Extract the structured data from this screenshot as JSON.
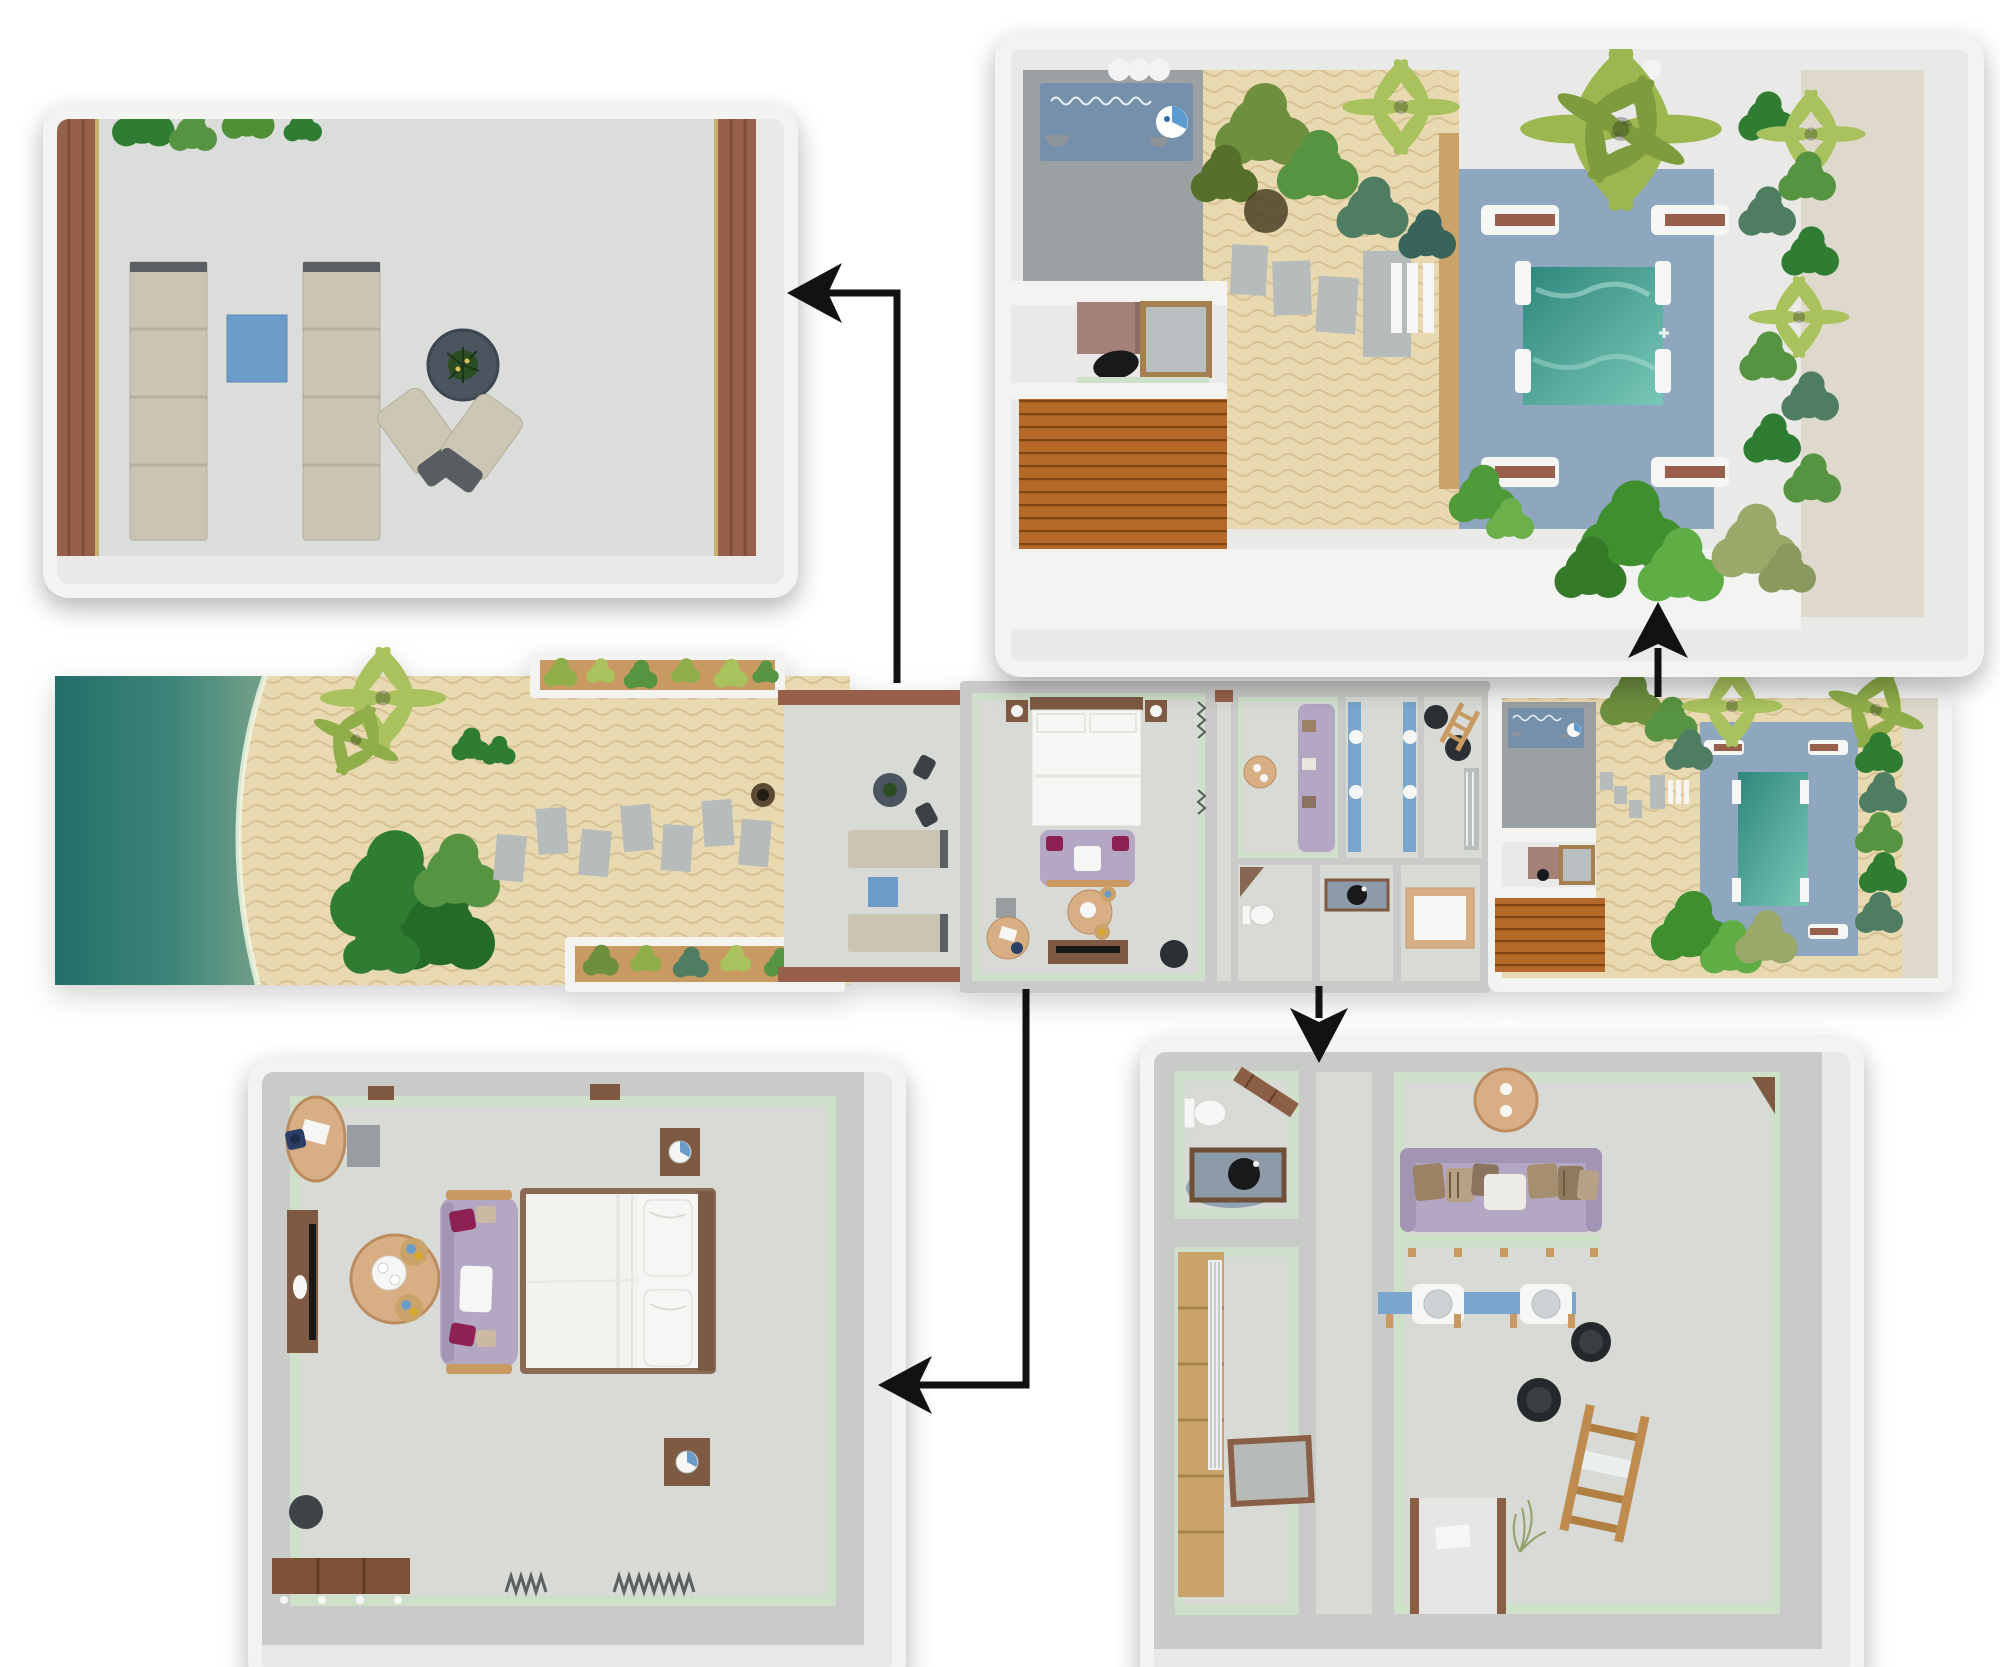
{
  "diagram": {
    "type": "floor-plan-with-callouts",
    "main_plan": {
      "id": "villa-plan-strip",
      "zones": [
        "ocean",
        "beach-sand",
        "palm-trees",
        "planter-boxes",
        "stepping-stones",
        "beach-terrace",
        "bedroom",
        "dressing-room",
        "vanity-room",
        "bathroom",
        "wood-deck",
        "courtyard-garden",
        "plunge-pool"
      ]
    },
    "panels": [
      {
        "id": "terrace-detail",
        "items": [
          "wood-deck-edge",
          "overhanging-foliage",
          "sun-lounger",
          "sun-lounger",
          "blue-side-table",
          "round-table-with-plant",
          "lounge-chair",
          "lounge-chair"
        ]
      },
      {
        "id": "courtyard-detail",
        "items": [
          "outdoor-rug",
          "wash-basin",
          "stool",
          "stool",
          "patio",
          "storage-cabinet",
          "window",
          "pouf",
          "wood-deck",
          "sand-garden",
          "stepping-stones",
          "white-loungers",
          "pool-deck",
          "plunge-pool",
          "sun-lounger",
          "sun-lounger",
          "sun-lounger",
          "sun-lounger",
          "palm-trees",
          "shrubs",
          "hedge"
        ]
      },
      {
        "id": "bedroom-detail",
        "items": [
          "desk",
          "desk-chair",
          "paper",
          "storage-box",
          "tv-console",
          "tv",
          "coffee-table",
          "serving-tray",
          "stool",
          "stool",
          "sofa",
          "accent-pillow",
          "accent-pillow",
          "throw-blanket",
          "double-bed",
          "pillows",
          "headboard",
          "nightstand",
          "table-lamp",
          "nightstand",
          "table-lamp",
          "pouf",
          "bench",
          "curtain",
          "curtain"
        ]
      },
      {
        "id": "bathroom-detail",
        "items": [
          "toilet",
          "wall-shelf",
          "vessel-sink-vanity",
          "bath-rug",
          "wardrobe",
          "floor-mat",
          "corridor",
          "round-table",
          "daybed-sofa",
          "pillows",
          "bench",
          "double-vanity",
          "sink",
          "sink",
          "stool",
          "stool",
          "towel-ladder",
          "towel",
          "entry-passage",
          "door-mat",
          "plant-sprig"
        ]
      }
    ],
    "arrows": [
      {
        "from": "villa-plan-strip.beach-terrace",
        "to": "terrace-detail",
        "pointing": "left"
      },
      {
        "from": "villa-plan-strip.courtyard-garden",
        "to": "courtyard-detail",
        "pointing": "up"
      },
      {
        "from": "villa-plan-strip.bedroom",
        "to": "bedroom-detail",
        "pointing": "left"
      },
      {
        "from": "villa-plan-strip.bathroom",
        "to": "bathroom-detail",
        "pointing": "down"
      }
    ]
  },
  "palette": {
    "bg": "#ffffff",
    "arrow": "#121212",
    "wall": "#e9eae7",
    "wallD": "#c9cbc8",
    "wallW": "#f3f4f2",
    "beige": "#ded9cc",
    "floor": "#d8dad6",
    "mint": "#cfe0ca",
    "sand": "#e9d9b0",
    "sandLn": "#c7ab72",
    "stone": "#b6bcbb",
    "patio": "#9ba1a3",
    "rug": "#7590aa",
    "basin": "#5b9bd0",
    "ocean1": "#226f68",
    "ocean2": "#3d8579",
    "ocean3": "#74a188",
    "ocean4": "#c0c39b",
    "foam": "#eef4e3",
    "deckO": "#b4692b",
    "deckOln": "#7e4512",
    "pooldeck": "#8fa6bf",
    "pool1": "#2e877b",
    "pool2": "#79c7b8",
    "lounger": "#cac4b2",
    "loungerE": "#5a5f63",
    "blue": "#6b9cc9",
    "lav": "#b4a7c3",
    "lavD": "#a295b4",
    "mag": "#8e2153",
    "tan": "#d8ae85",
    "tanLn": "#bc8c5f",
    "wood": "#96604a",
    "woodD": "#7e5a43",
    "woodL": "#c89a62",
    "white": "#f6f7f4",
    "g1": "#2e7d32",
    "g2": "#579442",
    "g3": "#8fae4a",
    "g4": "#a9c25e",
    "gteal": "#4e7d62",
    "sage": "#9aa86a",
    "olive": "#6d8f3e",
    "gdark": "#4a3f23",
    "black": "#17191b",
    "stool": "#2c2f33",
    "grayBox": "#9a9da0",
    "bathRug": "#8a9bb0",
    "counter": "#8d9aa8",
    "vanity": "#7aa6cd"
  }
}
